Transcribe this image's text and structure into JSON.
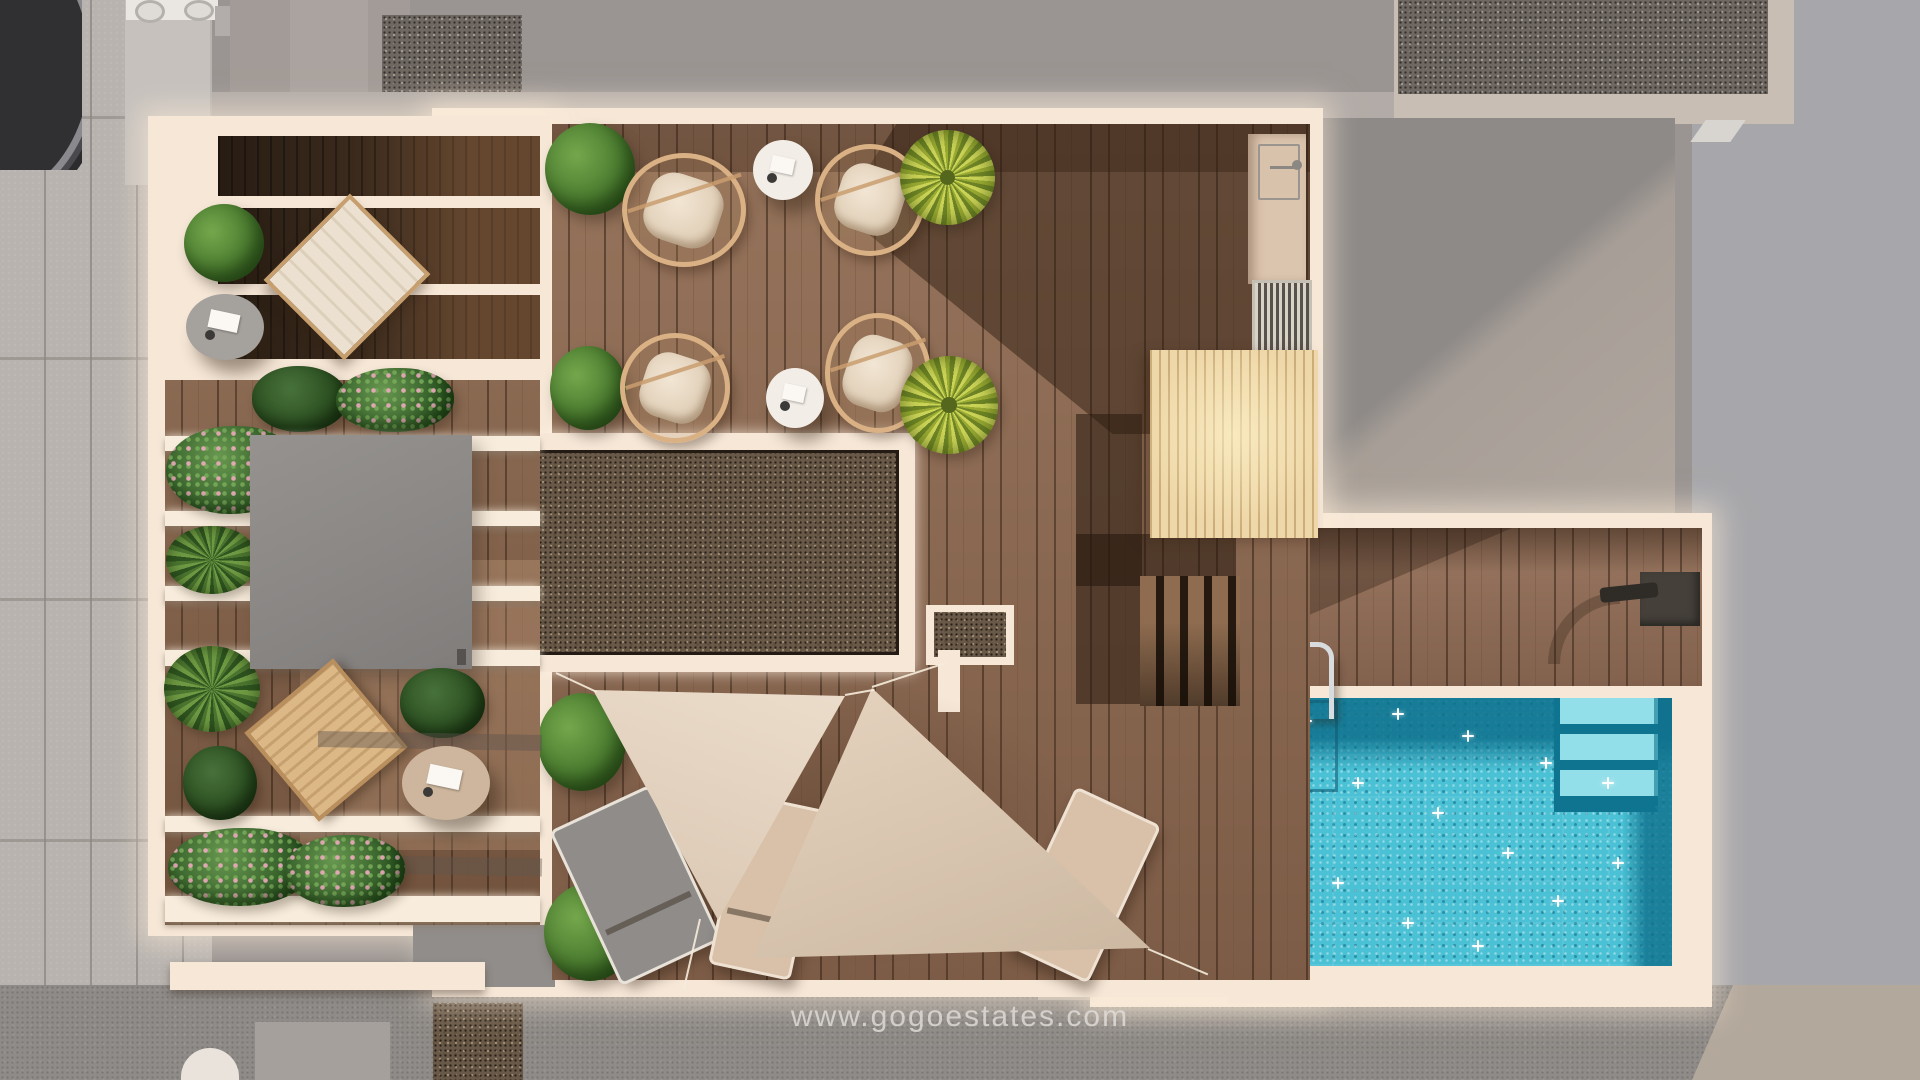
{
  "watermark": {
    "text": "www.gogoestates.com"
  },
  "scene": {
    "description_labels": {},
    "palette": {
      "pavement": "#b8b3af",
      "background_gray": "#9a9492",
      "cool_gray_right": "#a7a7ab",
      "terrace_trim_cream": "#f6e7d7",
      "deck_wood": "#8a6750",
      "dark_wood": "#3c2b1d",
      "pine_slats": "#eed7a8",
      "gravel": "#695948",
      "awning_gray": "#8c8987",
      "pool_water": "#4ac1d5",
      "pool_deep": "#0f7490",
      "pool_steps": "#93dfe9",
      "sail_fabric": "#e6d4c0",
      "lounger_gray": "#8f8c89",
      "lounger_beige": "#d9c0a8",
      "foliage_green": "#4a7b2f",
      "palm_yellow": "#ccd458"
    }
  }
}
